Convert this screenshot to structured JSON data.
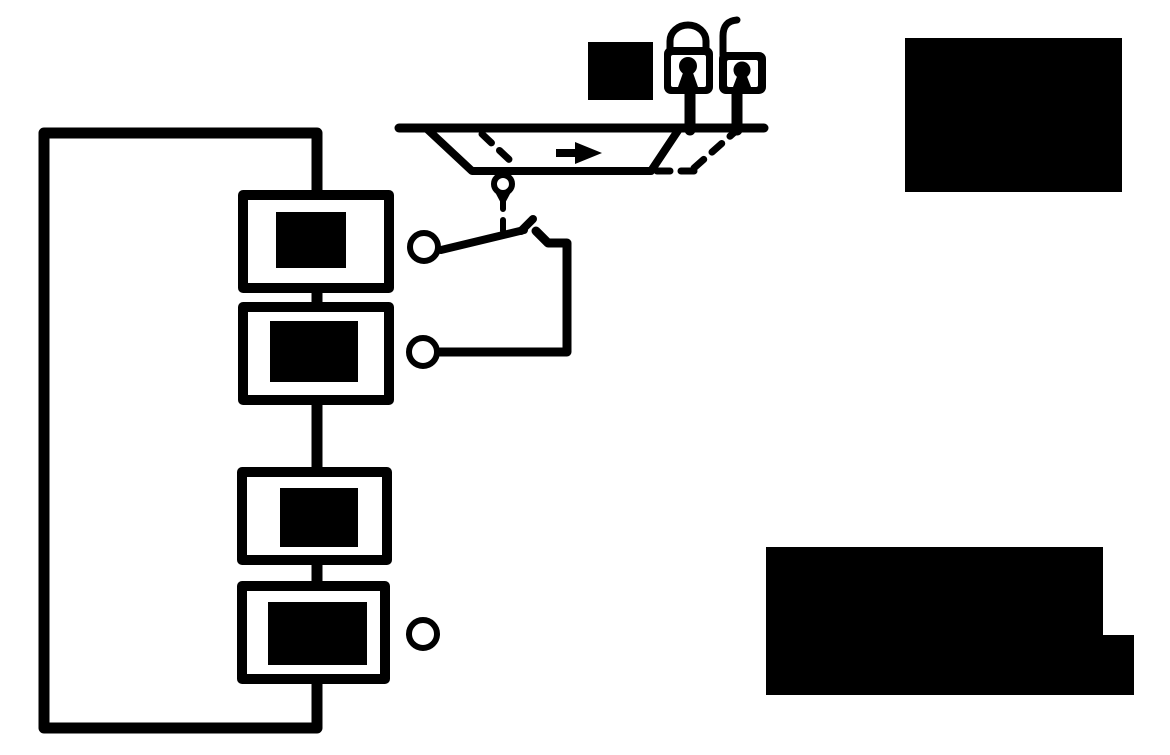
{
  "colors": {
    "ink": "#000000",
    "paper": "#ffffff"
  },
  "diagram": {
    "type": "schematic",
    "visible_text": "",
    "modules": {
      "count": 4,
      "connection": "series-feedback-loop",
      "labels_redacted": true
    },
    "terminals": {
      "count": 3
    },
    "switch": {
      "state": "open",
      "actuation": "dashed-line-from-roller"
    },
    "carriage": {
      "shape": "trapezoid-on-rail",
      "direction_arrow": "right",
      "ghost_position": "dashed-right"
    },
    "icons": [
      {
        "name": "padlock-closed-icon",
        "meaning": "locked state"
      },
      {
        "name": "padlock-open-icon",
        "meaning": "unlocked state"
      },
      {
        "name": "arrow-right-icon",
        "meaning": "travel direction"
      }
    ],
    "redaction_blocks": {
      "count": 3
    }
  }
}
